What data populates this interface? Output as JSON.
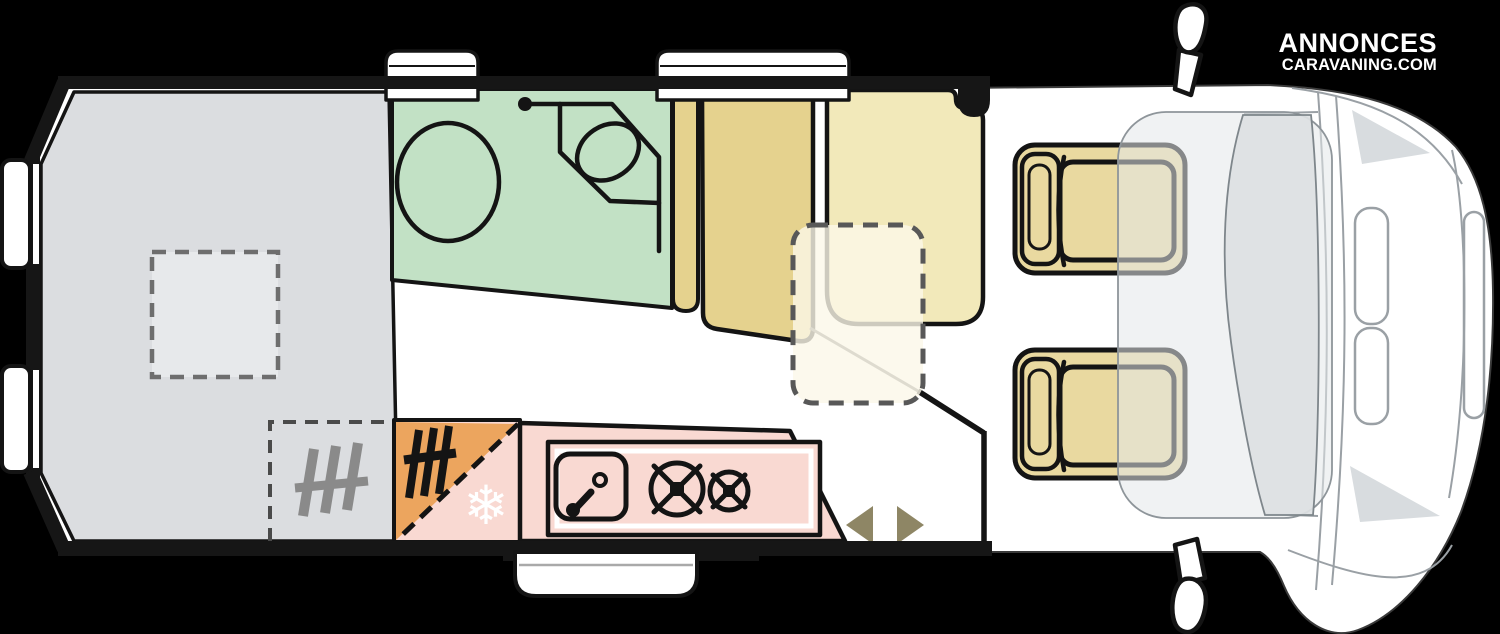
{
  "logo": {
    "line1": "ANNONCES",
    "line2": "CARAVANING.COM"
  },
  "icons": {
    "snowflake_glyph": "❄"
  },
  "plan": {
    "vehicle_type": "campervan-floorplan",
    "areas": [
      "rear-bed",
      "bathroom",
      "wardrobe",
      "dinette",
      "kitchen",
      "fridge-heater",
      "cab"
    ],
    "fixtures": [
      "toilet",
      "corner-basin",
      "kitchen-sink",
      "burner-large",
      "burner-small",
      "heater",
      "skylight",
      "table",
      "entry-step",
      "sliding-door-arrows",
      "cab-seat-top",
      "cab-seat-bottom",
      "mirror-top",
      "mirror-bottom"
    ]
  },
  "colors": {
    "background": "#000000",
    "wall": "#161616",
    "outline_black": "#141414",
    "body_white": "#ffffff",
    "bed_gray": "#dbdde0",
    "skylight_gray": "#e7e9eb",
    "bathroom_green": "#c2e1c5",
    "wardrobe_tan": "#e5d28e",
    "dinette_yellow": "#f2e9ba",
    "table_cream": "#fbf7e8",
    "cab_seat_tan": "#e9d9a0",
    "kitchen_pink": "#f9d9d2",
    "fridge_orange": "#eca55e",
    "arrow_olive": "#8e8665",
    "heater_gray": "#8a8a8a",
    "dash_gray": "#585858",
    "cab_line_gray": "#9aa0a5",
    "windshield_gray": "#dde1e3",
    "cab_floor_gray": "#e4e7e9",
    "corner_shade_gray": "#d8dcdf",
    "step_line_gray": "#a9a9a9"
  }
}
